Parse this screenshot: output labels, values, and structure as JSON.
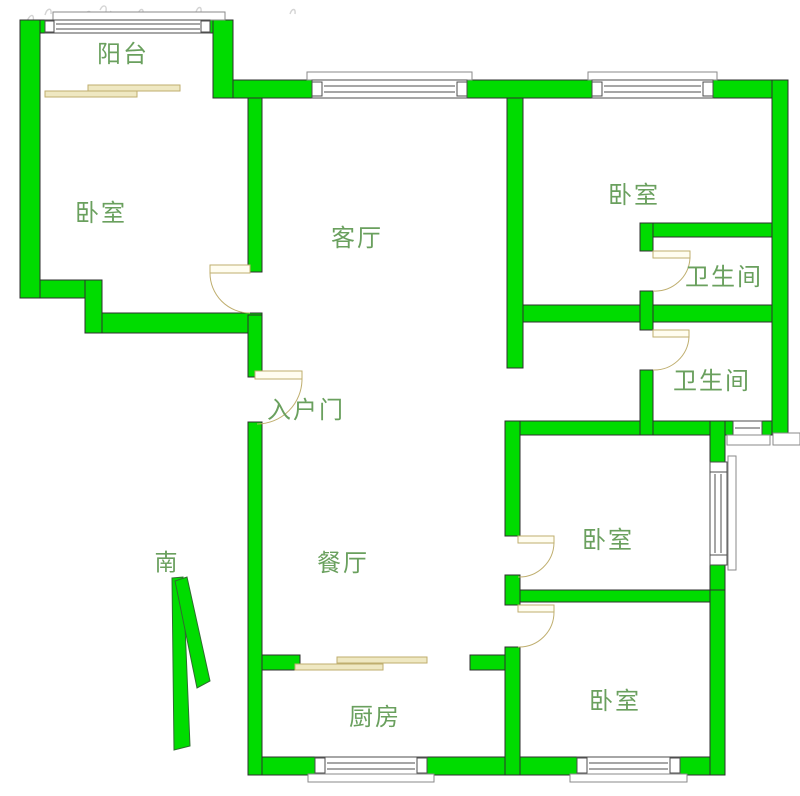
{
  "colors": {
    "wall_green": "#00dc00",
    "door_tan": "#bfae6e",
    "window_gray": "#4d4d4d",
    "label_green": "#6aa05e"
  },
  "rooms": [
    {
      "id": "balcony",
      "label": "阳台"
    },
    {
      "id": "bedroom-left",
      "label": "卧室"
    },
    {
      "id": "living-room",
      "label": "客厅"
    },
    {
      "id": "bedroom-top-right",
      "label": "卧室"
    },
    {
      "id": "bathroom-top",
      "label": "卫生间"
    },
    {
      "id": "bathroom-middle",
      "label": "卫生间"
    },
    {
      "id": "entrance",
      "label": "入户门"
    },
    {
      "id": "dining-room",
      "label": "餐厅"
    },
    {
      "id": "bedroom-middle-right",
      "label": "卧室"
    },
    {
      "id": "bedroom-bottom-right",
      "label": "卧室"
    },
    {
      "id": "kitchen",
      "label": "厨房"
    }
  ],
  "compass": {
    "south_label": "南"
  }
}
